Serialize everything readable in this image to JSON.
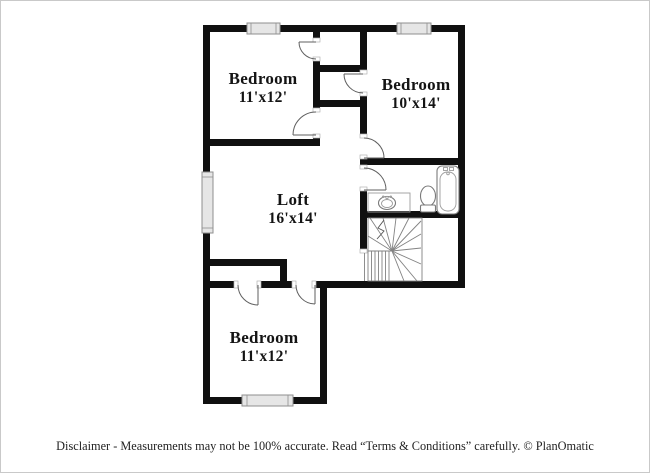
{
  "frame": {
    "background": "#ffffff",
    "border_color": "#c9c9c9",
    "wall_color": "#101010"
  },
  "plan": {
    "rooms": [
      {
        "name": "Bedroom",
        "dims": "11'x12'"
      },
      {
        "name": "Bedroom",
        "dims": "10'x14'"
      },
      {
        "name": "Loft",
        "dims": "16'x14'"
      },
      {
        "name": "Bedroom",
        "dims": "11'x12'"
      }
    ],
    "fixtures": [
      "bathtub-icon",
      "toilet-icon",
      "sink-vanity-icon",
      "staircase",
      "window",
      "door-swing"
    ]
  },
  "footer": {
    "disclaimer": "Disclaimer - Measurements may not be 100% accurate. Read “Terms & Conditions” carefully. © PlanOmatic"
  }
}
